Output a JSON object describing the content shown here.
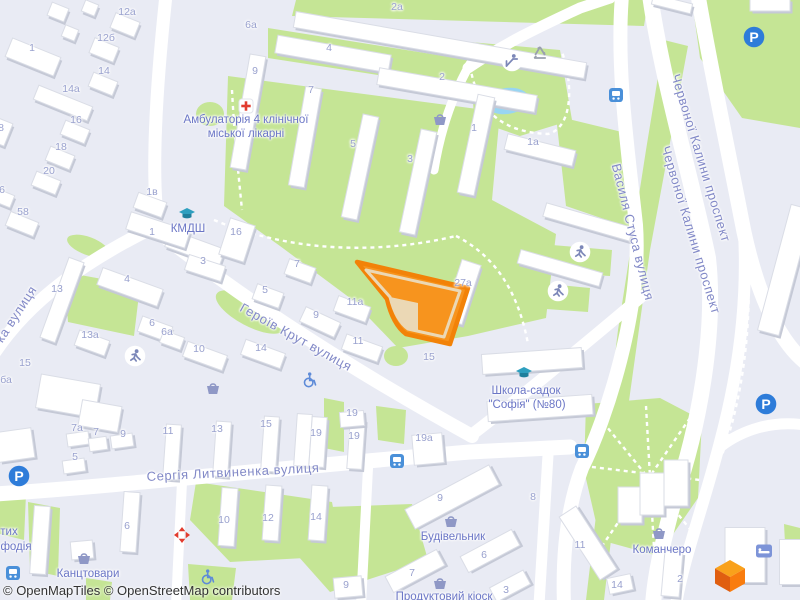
{
  "map": {
    "attribution": "© OpenMapTiles © OpenStreetMap contributors",
    "colors": {
      "land": "#E9EBF4",
      "road": "#FFFFFF",
      "green": "#C5E595",
      "water": "#98D5F2",
      "building": "#FFFFFF",
      "building_shadow": "#C5C9D6",
      "building_stroke": "#DADDE6",
      "street_label": "#8289C7",
      "poi_label": "#6B76C6",
      "number_label": "#99A1CE",
      "highlight_fill": "#F7941E",
      "highlight_border": "#F28208",
      "highlight_inner": "#EBD8B5",
      "parking_blue": "#2E7CD9",
      "bus_blue": "#4A90D9",
      "shop_icon": "#8F98C6",
      "figure_icon": "#7C87B8",
      "wheelchair_blue": "#5E8BD8",
      "education_teal": "#2E9FBF",
      "red_marker": "#E23B2E",
      "recycle_grey": "#9AA0AE",
      "attribution_text": "#333333",
      "logo_top": "#F9A11B",
      "logo_left": "#E05E10",
      "logo_right": "#F97C0E"
    },
    "streets": [
      {
        "text": "Героїв Крут вулиця",
        "x": 296,
        "y": 337,
        "rot": 29
      },
      {
        "text": "Сергія Литвиненка вулиця",
        "x": 233,
        "y": 472,
        "rot": -3
      },
      {
        "text": "Василя Стуса вулиця",
        "x": 633,
        "y": 232,
        "rot": 76
      },
      {
        "text": "Червоної Калини проспект",
        "x": 701,
        "y": 158,
        "rot": 73
      },
      {
        "text": "Червоної Калини проспект",
        "x": 691,
        "y": 230,
        "rot": 73
      },
      {
        "text": "ка вулиця",
        "x": 16,
        "y": 314,
        "rot": -57
      }
    ],
    "pois": [
      {
        "text": "Амбулаторія 4 клінічної",
        "x": 246,
        "y": 120
      },
      {
        "text": "міської лікарні",
        "x": 246,
        "y": 134
      },
      {
        "text": "КМДШ",
        "x": 188,
        "y": 229
      },
      {
        "text": "Школа-садок",
        "x": 526,
        "y": 391
      },
      {
        "text": "\"Софія\" (№80)",
        "x": 527,
        "y": 405
      },
      {
        "text": "Канцтовари",
        "x": 88,
        "y": 574
      },
      {
        "text": "Будівельник",
        "x": 453,
        "y": 537
      },
      {
        "text": "Продуктовий кіоск",
        "x": 444,
        "y": 597
      },
      {
        "text": "Команчеро",
        "x": 662,
        "y": 550
      },
      {
        "text": "тих",
        "x": 9,
        "y": 532
      },
      {
        "text": "фодія",
        "x": 16,
        "y": 547
      }
    ],
    "numbers": [
      {
        "t": "1",
        "x": 32,
        "y": 48
      },
      {
        "t": "12а",
        "x": 127,
        "y": 12
      },
      {
        "t": "12б",
        "x": 106,
        "y": 38
      },
      {
        "t": "14",
        "x": 104,
        "y": 71
      },
      {
        "t": "14а",
        "x": 71,
        "y": 89
      },
      {
        "t": "16",
        "x": 76,
        "y": 120
      },
      {
        "t": "18",
        "x": 61,
        "y": 147
      },
      {
        "t": "20",
        "x": 49,
        "y": 171
      },
      {
        "t": "58",
        "x": 23,
        "y": 212
      },
      {
        "t": "8",
        "x": 1,
        "y": 128
      },
      {
        "t": "6",
        "x": 2,
        "y": 190
      },
      {
        "t": "2а",
        "x": 397,
        "y": 7
      },
      {
        "t": "4",
        "x": 329,
        "y": 48
      },
      {
        "t": "2",
        "x": 442,
        "y": 77
      },
      {
        "t": "9",
        "x": 255,
        "y": 71
      },
      {
        "t": "6а",
        "x": 251,
        "y": 25
      },
      {
        "t": "7",
        "x": 311,
        "y": 90
      },
      {
        "t": "5",
        "x": 353,
        "y": 144
      },
      {
        "t": "3",
        "x": 410,
        "y": 159
      },
      {
        "t": "1",
        "x": 474,
        "y": 128
      },
      {
        "t": "1а",
        "x": 533,
        "y": 142
      },
      {
        "t": "1в",
        "x": 152,
        "y": 192
      },
      {
        "t": "1",
        "x": 152,
        "y": 232
      },
      {
        "t": "16",
        "x": 236,
        "y": 232
      },
      {
        "t": "3",
        "x": 203,
        "y": 261
      },
      {
        "t": "13",
        "x": 57,
        "y": 289
      },
      {
        "t": "4",
        "x": 127,
        "y": 279
      },
      {
        "t": "5",
        "x": 265,
        "y": 290
      },
      {
        "t": "7",
        "x": 297,
        "y": 264
      },
      {
        "t": "9",
        "x": 316,
        "y": 315
      },
      {
        "t": "11а",
        "x": 355,
        "y": 302
      },
      {
        "t": "11",
        "x": 358,
        "y": 341
      },
      {
        "t": "27а",
        "x": 463,
        "y": 283
      },
      {
        "t": "15",
        "x": 429,
        "y": 357
      },
      {
        "t": "10",
        "x": 199,
        "y": 349
      },
      {
        "t": "6",
        "x": 152,
        "y": 323
      },
      {
        "t": "6а",
        "x": 167,
        "y": 332
      },
      {
        "t": "13а",
        "x": 90,
        "y": 335
      },
      {
        "t": "15",
        "x": 25,
        "y": 363
      },
      {
        "t": "14",
        "x": 261,
        "y": 348
      },
      {
        "t": "ба",
        "x": 6,
        "y": 380
      },
      {
        "t": "7а",
        "x": 77,
        "y": 428
      },
      {
        "t": "7",
        "x": 96,
        "y": 432
      },
      {
        "t": "9",
        "x": 123,
        "y": 434
      },
      {
        "t": "5",
        "x": 75,
        "y": 457
      },
      {
        "t": "11",
        "x": 168,
        "y": 431
      },
      {
        "t": "13",
        "x": 217,
        "y": 429
      },
      {
        "t": "15",
        "x": 266,
        "y": 424
      },
      {
        "t": "19",
        "x": 352,
        "y": 413
      },
      {
        "t": "19",
        "x": 316,
        "y": 433
      },
      {
        "t": "19",
        "x": 354,
        "y": 436
      },
      {
        "t": "19а",
        "x": 424,
        "y": 438
      },
      {
        "t": "6",
        "x": 127,
        "y": 526
      },
      {
        "t": "10",
        "x": 224,
        "y": 520
      },
      {
        "t": "12",
        "x": 268,
        "y": 518
      },
      {
        "t": "14",
        "x": 316,
        "y": 517
      },
      {
        "t": "9",
        "x": 440,
        "y": 498
      },
      {
        "t": "6",
        "x": 484,
        "y": 555
      },
      {
        "t": "7",
        "x": 412,
        "y": 573
      },
      {
        "t": "3",
        "x": 506,
        "y": 590
      },
      {
        "t": "9",
        "x": 346,
        "y": 585
      },
      {
        "t": "8",
        "x": 533,
        "y": 497
      },
      {
        "t": "11",
        "x": 580,
        "y": 545
      },
      {
        "t": "14",
        "x": 617,
        "y": 585
      },
      {
        "t": "2",
        "x": 680,
        "y": 579
      }
    ],
    "icons": [
      {
        "type": "parking",
        "x": 754,
        "y": 37
      },
      {
        "type": "parking",
        "x": 19,
        "y": 476
      },
      {
        "type": "parking",
        "x": 766,
        "y": 404
      },
      {
        "type": "bus",
        "x": 616,
        "y": 95
      },
      {
        "type": "bus",
        "x": 397,
        "y": 461
      },
      {
        "type": "bus",
        "x": 582,
        "y": 451
      },
      {
        "type": "bus",
        "x": 13,
        "y": 573
      },
      {
        "type": "basket",
        "x": 440,
        "y": 119
      },
      {
        "type": "basket",
        "x": 213,
        "y": 388
      },
      {
        "type": "basket",
        "x": 84,
        "y": 558
      },
      {
        "type": "basket",
        "x": 451,
        "y": 521
      },
      {
        "type": "basket",
        "x": 440,
        "y": 583
      },
      {
        "type": "basket",
        "x": 659,
        "y": 533
      },
      {
        "type": "runner",
        "x": 580,
        "y": 252
      },
      {
        "type": "runner",
        "x": 558,
        "y": 291
      },
      {
        "type": "runner",
        "x": 135,
        "y": 356
      },
      {
        "type": "playground",
        "x": 512,
        "y": 61
      },
      {
        "type": "wheelchair",
        "x": 310,
        "y": 380
      },
      {
        "type": "wheelchair",
        "x": 208,
        "y": 577
      },
      {
        "type": "recycle",
        "x": 540,
        "y": 53
      },
      {
        "type": "hospital",
        "x": 246,
        "y": 106
      },
      {
        "type": "cap",
        "x": 187,
        "y": 214
      },
      {
        "type": "cap",
        "x": 524,
        "y": 373
      },
      {
        "type": "redarrows",
        "x": 182,
        "y": 535
      },
      {
        "type": "bed",
        "x": 764,
        "y": 551
      }
    ]
  }
}
